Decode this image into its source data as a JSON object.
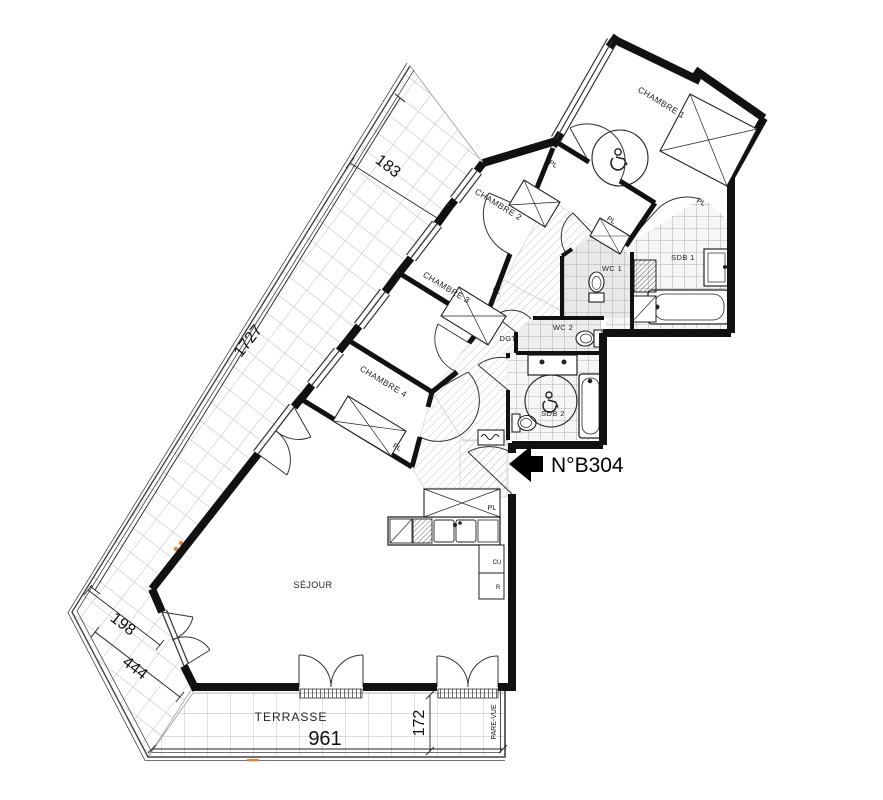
{
  "plan": {
    "unit": "N°B304",
    "rooms": {
      "chambre1": "CHAMBRE 1",
      "chambre2": "CHAMBRE 2",
      "chambre3": "CHAMBRE 3",
      "chambre4": "CHAMBRE 4",
      "sejour": "SÉJOUR",
      "sdb1": "SDB 1",
      "sdb2": "SDB 2",
      "wc1": "WC 1",
      "wc2": "WC 2",
      "dgt": "DGT",
      "terrasse": "TERRASSE"
    },
    "labels": {
      "closet": "PL",
      "kitchen_unit": "CU",
      "fridge": "R",
      "screen": "PARE-VUE"
    },
    "dimensions": {
      "balcony_width": "183",
      "balcony_length": "1727",
      "bend_width": "198",
      "bend_length": "444",
      "terrace_length": "961",
      "terrace_depth": "172"
    },
    "colors": {
      "wall": "#111111",
      "accent": "#e8823c",
      "tile": "#b9b9b9"
    }
  }
}
